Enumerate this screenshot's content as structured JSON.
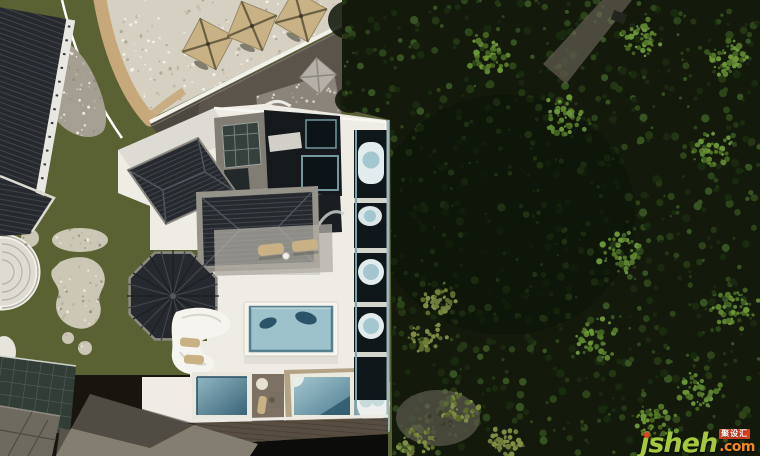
{
  "meta": {
    "type": "aerial-drone-photograph",
    "width": 760,
    "height": 456,
    "description": "Top-down drone view of a white modern villa with dark tiled hip roofs, an octagonal pavilion roof, rooftop swimming pools and a column of private tubs; landscaped grounds with pebble terraces, tan patio umbrellas, stone paths and lawn on the left; dense dark forest canopy covering the right half"
  },
  "watermark": {
    "brand": "jsheh",
    "tld": ".com",
    "badge": "聚设汇"
  },
  "colors": {
    "forest": "#131a0c",
    "grass": "#5a6133",
    "pebble": "#d5d0c1",
    "sand": "#c7a87a",
    "asphalt": "#5a544b",
    "stone": "#a59f91",
    "stone2": "#ccc6b4",
    "villa": "#eeece5",
    "roofDark": "#26292d",
    "concrete": "#827d74",
    "water": "#9dc2cc",
    "waterDeep": "#35617a",
    "teal": "#7fa3ab",
    "tan": "#c8b184",
    "woodTan": "#b3a284",
    "deck": "#574d40",
    "wmGreen": "#a4c93c",
    "wmOrange": "#f2891d",
    "wmRed": "#e2401d"
  }
}
